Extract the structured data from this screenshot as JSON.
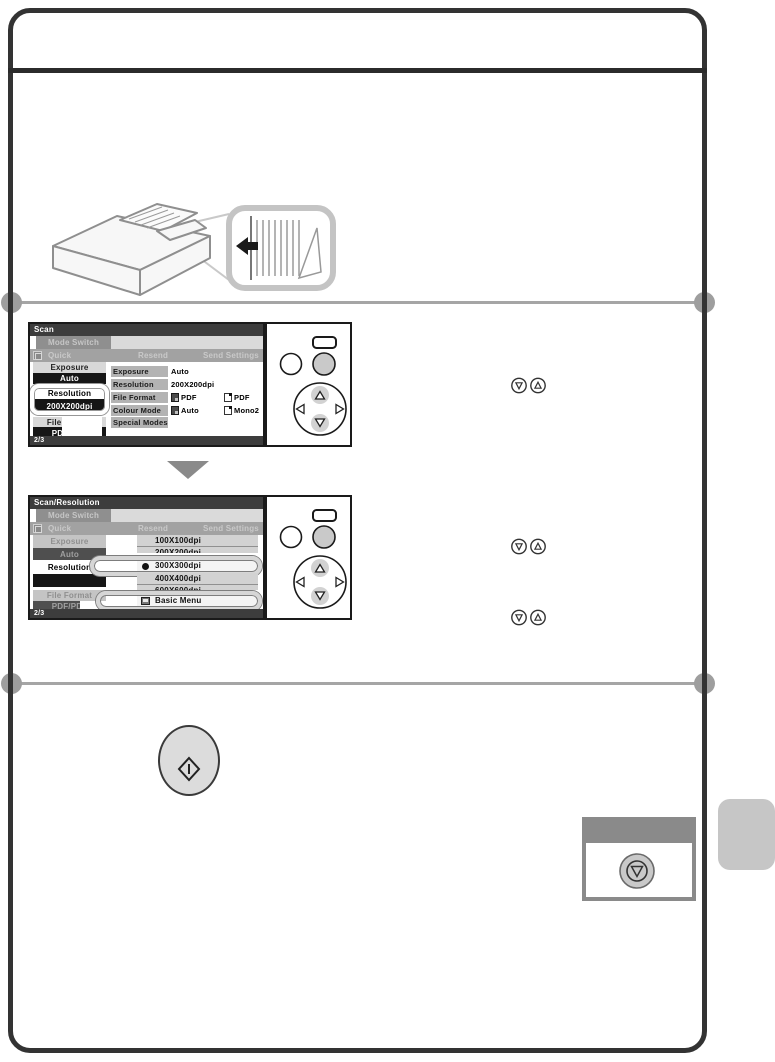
{
  "colors": {
    "frame": "#333333",
    "screen_title_bar": "#3d3d3d",
    "screen_black_button": "#161616",
    "screen_gray_button": "#d8d8d8",
    "table_label_cell": "#b3b3b3",
    "list_row": "#d2d2d2",
    "section_divider": "#a5a5a5",
    "arrow_gray": "#8a8a8a",
    "hardware_button": "#dcdcdc",
    "stop_panel_border": "#8a8a8a",
    "side_tab": "#c6c6c6"
  },
  "icons": {
    "key_hint_down": "▽",
    "key_hint_up": "△",
    "start_button_glyph": "diamond-with-bar",
    "stop_button_glyph": "circle-with-down-triangle",
    "feed_direction_arrow": "left-arrow",
    "selected_item_bullet": "●"
  },
  "screen1": {
    "title": "Scan",
    "mode_switch": "Mode Switch",
    "tab_quick": "Quick",
    "tab_resend": "Resend",
    "tab_send_settings": "Send Settings",
    "sidebar": {
      "exposure_label": "Exposure",
      "exposure_value": "Auto",
      "resolution_label": "Resolution",
      "resolution_value": "200X200dpi",
      "file_format_label": "File Format",
      "file_format_value": "PDF/PDF"
    },
    "table": [
      {
        "label": "Exposure",
        "value1": "Auto"
      },
      {
        "label": "Resolution",
        "value1": "200X200dpi"
      },
      {
        "label": "File Format",
        "value1": "PDF",
        "value2": "PDF"
      },
      {
        "label": "Colour Mode",
        "value1": "Auto",
        "value2": "Mono2"
      },
      {
        "label": "Special Modes"
      }
    ],
    "page_indicator": "2/3"
  },
  "screen2": {
    "title": "Scan/Resolution",
    "mode_switch": "Mode Switch",
    "tab_quick": "Quick",
    "tab_resend": "Resend",
    "tab_send_settings": "Send Settings",
    "sidebar": {
      "exposure_label": "Exposure",
      "exposure_value": "Auto",
      "resolution_label": "Resolution",
      "file_format_label": "File Format",
      "file_format_value": "PDF/PDF"
    },
    "list": {
      "items": [
        "100X100dpi",
        "200X200dpi",
        "300X300dpi",
        "400X400dpi",
        "600X600dpi"
      ],
      "selected": "300X300dpi",
      "basic_menu": "Basic Menu"
    },
    "page_indicator": "2/3"
  }
}
